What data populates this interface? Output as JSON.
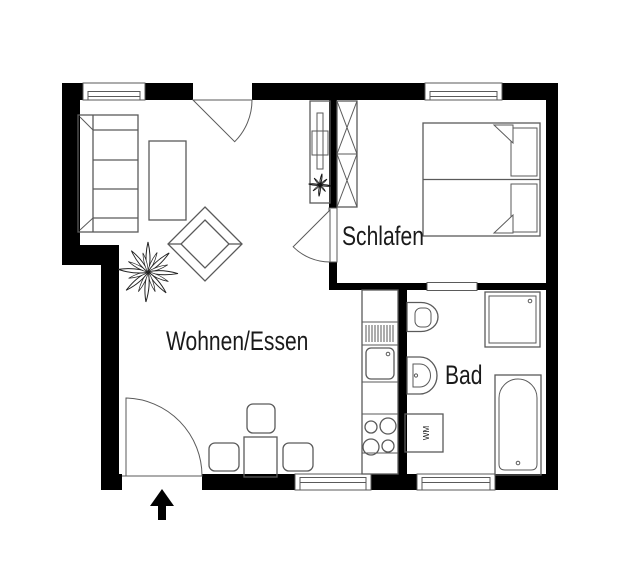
{
  "floorplan": {
    "labels": {
      "living_dining": "Wohnen/Essen",
      "bedroom": "Schlafen",
      "bathroom": "Bad",
      "washing_machine": "WM"
    },
    "colors": {
      "wall": "#000000",
      "outline": "#5a5a5a",
      "text": "#1a1a1a",
      "background": "#ffffff"
    }
  }
}
